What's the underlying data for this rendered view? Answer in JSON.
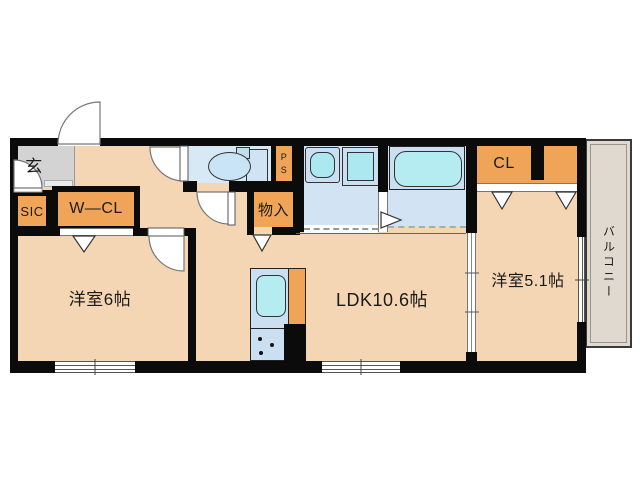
{
  "floorplan": {
    "type": "japanese-apartment-floorplan",
    "rooms": {
      "entrance": {
        "label": "玄"
      },
      "shoe_closet": {
        "label": "SIC"
      },
      "walk_in_closet": {
        "label": "W—CL"
      },
      "western_room_6": {
        "label": "洋室6帖"
      },
      "storage": {
        "label": "物入"
      },
      "pipe_space": {
        "label": "PS",
        "line1": "P",
        "line2": "S"
      },
      "ldk": {
        "label": "LDK10.6帖"
      },
      "closet": {
        "label": "CL"
      },
      "western_room_51": {
        "label": "洋室5.1帖"
      },
      "balcony": {
        "label": "バルコニー"
      }
    },
    "colors": {
      "wall": "#0b0b0b",
      "floor_beige": "#f4d6b5",
      "closet_orange": "#f0a457",
      "entrance_gray": "#d3d3d3",
      "wet_area_blue": "#d2e3f4",
      "fixture_cyan": "#b5ecf2",
      "balcony_gray": "#e0d9d0"
    }
  }
}
